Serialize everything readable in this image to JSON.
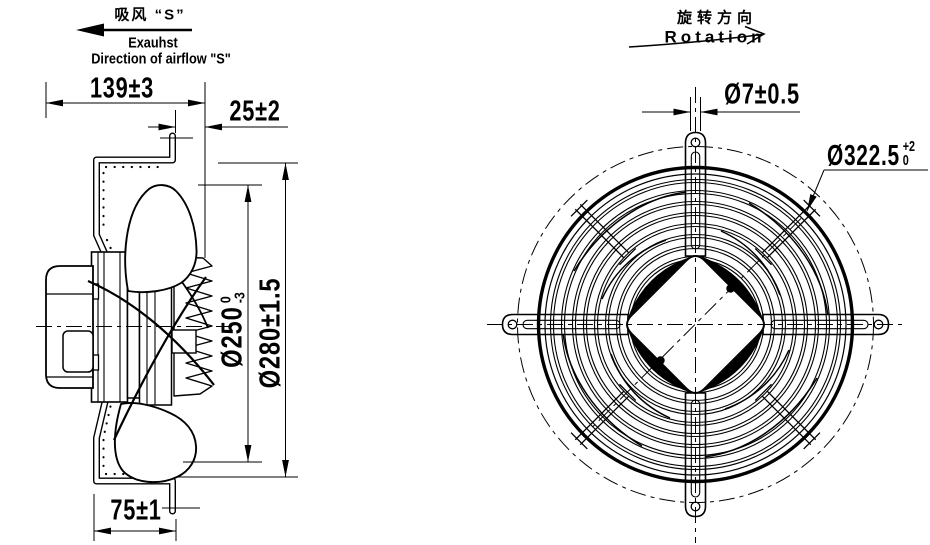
{
  "meta": {
    "title": "Axial fan technical drawing",
    "ink_color": "#000000",
    "background_color": "#ffffff",
    "symbols": {
      "airflow_arrow": "left-filled-arrow",
      "rotation_arrow": "curved-right-arrow",
      "dimension_arrow": "cad-slender-arrowhead"
    }
  },
  "airflow_note": {
    "zh": "吸风 “S”",
    "en1": "Exauhst",
    "en2": "Direction of airflow \"S\""
  },
  "rotation_note": {
    "zh": "旋转方向",
    "en": "Rotation"
  },
  "side_view": {
    "dims": {
      "depth": "139±3",
      "guard_offset": "25±2",
      "foot": "75±1",
      "impeller_dia": {
        "text": "Ø250",
        "tol_upper": "0",
        "tol_lower": "-3"
      },
      "plate_dia": "Ø280±1.5"
    }
  },
  "front_view": {
    "dims": {
      "hole_dia": "Ø7±0.5",
      "guard_dia": {
        "text": "Ø322.5",
        "tol_upper": "+2",
        "tol_lower": "0"
      }
    }
  }
}
